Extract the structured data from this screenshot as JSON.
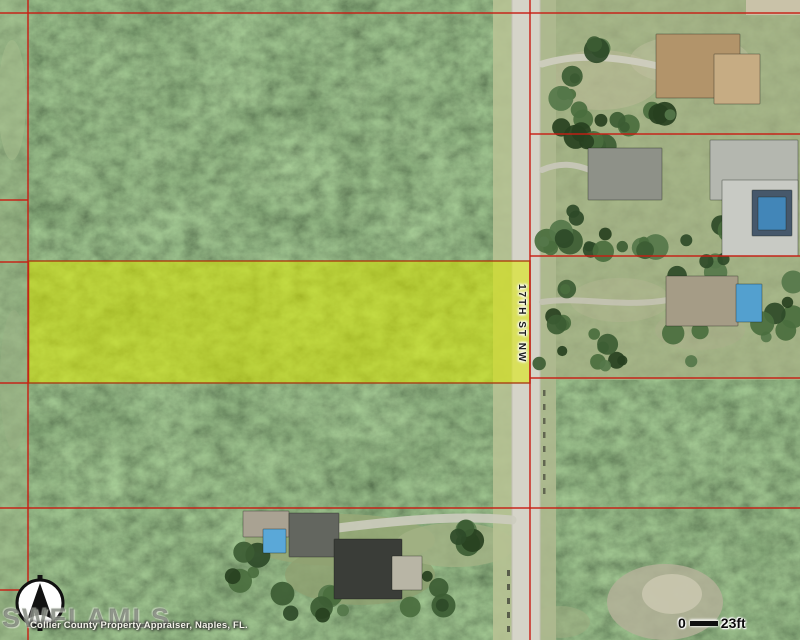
{
  "map": {
    "road_label": "17TH ST NW",
    "watermark": "SWFLAMLS",
    "attribution": "Collier County Property Appraiser, Naples, FL.",
    "scale_bar": {
      "start": "0",
      "end": "23ft"
    },
    "north_arrow_icon": "north-arrow-compass",
    "colors": {
      "parcel_line": "#c81e14",
      "highlight_fill": "#dcea00",
      "highlight_border": "#a83c10",
      "forest_base": "#3a5530",
      "lawn": "#a9b287",
      "road_pavement": "#d5d4c8",
      "pool_blue": "#53a0cf"
    },
    "features": {
      "road": {
        "shoulder_left": {
          "x": 493,
          "w": 19,
          "color": "#b7c294"
        },
        "pavement": {
          "x": 512,
          "w": 28,
          "color": "#d5d4c8"
        },
        "shoulder_right": {
          "x": 540,
          "w": 16,
          "color": "#aeb98f"
        },
        "edge_color": "#c2c1b4"
      },
      "highlight_parcel": {
        "x": 28.5,
        "y": 261,
        "w": 501.5,
        "h": 122,
        "fill": "#dcea00",
        "opacity": 0.55,
        "stroke": "#a83c10"
      },
      "parcel_lines": [
        {
          "x1": 28,
          "y1": 0,
          "x2": 28,
          "y2": 640
        },
        {
          "x1": 530,
          "y1": 0,
          "x2": 530,
          "y2": 640
        },
        {
          "x1": 0,
          "y1": 13,
          "x2": 800,
          "y2": 13
        },
        {
          "x1": 530,
          "y1": 134,
          "x2": 800,
          "y2": 134
        },
        {
          "x1": 0,
          "y1": 200,
          "x2": 28,
          "y2": 200
        },
        {
          "x1": 0,
          "y1": 262,
          "x2": 28,
          "y2": 262
        },
        {
          "x1": 530,
          "y1": 256,
          "x2": 800,
          "y2": 256
        },
        {
          "x1": 530,
          "y1": 378,
          "x2": 800,
          "y2": 378
        },
        {
          "x1": 0,
          "y1": 383,
          "x2": 28,
          "y2": 383
        },
        {
          "x1": 0,
          "y1": 508,
          "x2": 800,
          "y2": 508
        },
        {
          "x1": 0,
          "y1": 590,
          "x2": 28,
          "y2": 590
        }
      ],
      "clearings": [
        {
          "cx": 340,
          "cy": 540,
          "rx": 95,
          "ry": 26,
          "fill": "#97a877",
          "opacity": 0.85
        },
        {
          "cx": 360,
          "cy": 575,
          "rx": 75,
          "ry": 30,
          "fill": "#8fa070",
          "opacity": 0.8
        },
        {
          "cx": 455,
          "cy": 545,
          "rx": 60,
          "ry": 22,
          "fill": "#a3b184",
          "opacity": 0.8
        },
        {
          "cx": 665,
          "cy": 602,
          "rx": 58,
          "ry": 38,
          "fill": "#b3b098",
          "opacity": 0.85
        },
        {
          "cx": 672,
          "cy": 594,
          "rx": 30,
          "ry": 20,
          "fill": "#c9c6ae",
          "opacity": 0.9
        },
        {
          "cx": 560,
          "cy": 622,
          "rx": 30,
          "ry": 16,
          "fill": "#9dab80",
          "opacity": 0.6
        }
      ],
      "driveways": [
        {
          "d": "M542,64 C580,52 622,58 658,66",
          "w": 7,
          "color": "#cfcec0"
        },
        {
          "d": "M542,170 C560,162 574,164 590,170",
          "w": 6,
          "color": "#c9c8ba"
        },
        {
          "d": "M542,302 C580,296 620,308 668,300",
          "w": 6,
          "color": "#c4c3b3"
        },
        {
          "d": "M512,520 C450,514 380,522 292,534",
          "w": 9,
          "color": "#ccccbe"
        }
      ],
      "tree_clusters": [
        {
          "cx": 562,
          "cy": 96,
          "rx": 22,
          "ry": 34,
          "n": 7,
          "seed": 1
        },
        {
          "cx": 606,
          "cy": 124,
          "rx": 32,
          "ry": 16,
          "n": 6,
          "seed": 2
        },
        {
          "cx": 612,
          "cy": 142,
          "rx": 48,
          "ry": 10,
          "n": 6,
          "seed": 3
        },
        {
          "cx": 560,
          "cy": 228,
          "rx": 18,
          "ry": 26,
          "n": 6,
          "seed": 4
        },
        {
          "cx": 630,
          "cy": 236,
          "rx": 70,
          "ry": 18,
          "n": 12,
          "seed": 5
        },
        {
          "cx": 745,
          "cy": 228,
          "rx": 38,
          "ry": 16,
          "n": 8,
          "seed": 6
        },
        {
          "cx": 554,
          "cy": 330,
          "rx": 16,
          "ry": 44,
          "n": 8,
          "seed": 7
        },
        {
          "cx": 648,
          "cy": 348,
          "rx": 58,
          "ry": 22,
          "n": 10,
          "seed": 8
        },
        {
          "cx": 778,
          "cy": 310,
          "rx": 22,
          "ry": 42,
          "n": 7,
          "seed": 9
        },
        {
          "cx": 700,
          "cy": 268,
          "rx": 28,
          "ry": 10,
          "n": 5,
          "seed": 10
        },
        {
          "cx": 586,
          "cy": 54,
          "rx": 18,
          "ry": 10,
          "n": 3,
          "seed": 11
        },
        {
          "cx": 664,
          "cy": 114,
          "rx": 22,
          "ry": 8,
          "n": 4,
          "seed": 12
        },
        {
          "cx": 250,
          "cy": 562,
          "rx": 18,
          "ry": 22,
          "n": 5,
          "seed": 13
        },
        {
          "cx": 312,
          "cy": 602,
          "rx": 38,
          "ry": 16,
          "n": 7,
          "seed": 14
        },
        {
          "cx": 436,
          "cy": 592,
          "rx": 28,
          "ry": 18,
          "n": 6,
          "seed": 15
        },
        {
          "cx": 470,
          "cy": 540,
          "rx": 24,
          "ry": 14,
          "n": 5,
          "seed": 16
        }
      ],
      "houses": [
        {
          "name": "tan-roof-house",
          "x": 656,
          "y": 34,
          "w": 84,
          "h": 64,
          "fill": "#b2946a"
        },
        {
          "name": "garage",
          "x": 714,
          "y": 54,
          "w": 46,
          "h": 50,
          "fill": "#c6ac83"
        },
        {
          "name": "gray-roof-house",
          "x": 588,
          "y": 148,
          "w": 74,
          "h": 52,
          "fill": "#8e9188"
        },
        {
          "name": "large-house",
          "x": 710,
          "y": 140,
          "w": 88,
          "h": 60,
          "fill": "#b4b7af"
        },
        {
          "name": "large-house-wing",
          "x": 722,
          "y": 180,
          "w": 76,
          "h": 76,
          "fill": "#c8cac4"
        },
        {
          "name": "pool-enclosure",
          "x": 752,
          "y": 190,
          "w": 40,
          "h": 46,
          "fill": "#46586b"
        },
        {
          "name": "pool",
          "x": 758,
          "y": 197,
          "w": 28,
          "h": 33,
          "fill": "#4286b8"
        },
        {
          "name": "tan-house",
          "x": 666,
          "y": 276,
          "w": 72,
          "h": 50,
          "fill": "#a59c86"
        },
        {
          "name": "pool",
          "x": 736,
          "y": 284,
          "w": 26,
          "h": 38,
          "fill": "#53a0cf"
        },
        {
          "name": "shed",
          "x": 243,
          "y": 511,
          "w": 46,
          "h": 26,
          "fill": "#a9a292"
        },
        {
          "name": "pool",
          "x": 263,
          "y": 529,
          "w": 23,
          "h": 24,
          "fill": "#5aa8d8"
        },
        {
          "name": "gray-house",
          "x": 289,
          "y": 513,
          "w": 50,
          "h": 44,
          "fill": "#63665f"
        },
        {
          "name": "dark-roof-house",
          "x": 334,
          "y": 539,
          "w": 68,
          "h": 60,
          "fill": "#3a3d38"
        },
        {
          "name": "driveway-pad",
          "x": 392,
          "y": 556,
          "w": 30,
          "h": 34,
          "fill": "#b8b5a5"
        }
      ]
    }
  }
}
